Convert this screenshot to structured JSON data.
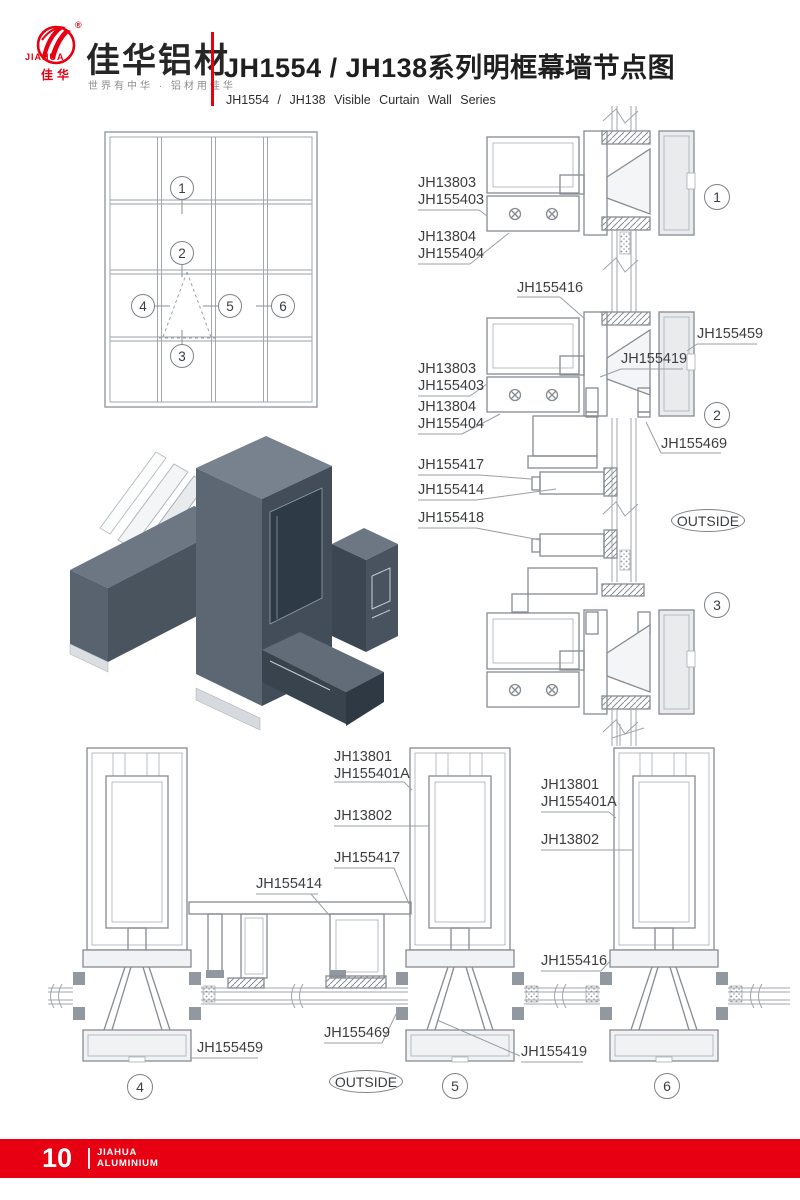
{
  "header": {
    "logo": {
      "registered": "®",
      "brand": "JIAHUA",
      "brand_cn": "佳华"
    },
    "company": "佳华铝材",
    "slogan": "世界有中华 · 铝材用佳华",
    "title": "JH1554 / JH138系列明框幕墙节点图",
    "subtitle": "JH1554 / JH138 Visible Curtain Wall Series",
    "accent_color": "#e60012"
  },
  "callouts": {
    "c1": "1",
    "c2": "2",
    "c3": "3",
    "c4": "4",
    "c5": "5",
    "c6": "6"
  },
  "parts": {
    "d1_a": "JH13803",
    "d1_b": "JH155403",
    "d1_c": "JH13804",
    "d1_d": "JH155404",
    "d2_top": "JH155416",
    "d2_a": "JH13803",
    "d2_b": "JH155403",
    "d2_c": "JH13804",
    "d2_d": "JH155404",
    "d2_right": "JH155459",
    "d2_mid": "JH155419",
    "d2_bottom": "JH155469",
    "mid_a": "JH155417",
    "mid_b": "JH155414",
    "mid_c": "JH155418",
    "d4_a": "JH155414",
    "d4_b": "JH155459",
    "d5_a": "JH13801",
    "d5_b": "JH155401A",
    "d5_c": "JH13802",
    "d5_d": "JH155417",
    "d5_e": "JH155469",
    "d5_f": "JH155419",
    "d6_a": "JH13801",
    "d6_b": "JH155401A",
    "d6_c": "JH13802",
    "d6_d": "JH155416"
  },
  "outside_label": "OUTSIDE",
  "footer": {
    "page_number": "10",
    "brand_top": "JIAHUA",
    "brand_bottom": "ALUMINIUM"
  }
}
